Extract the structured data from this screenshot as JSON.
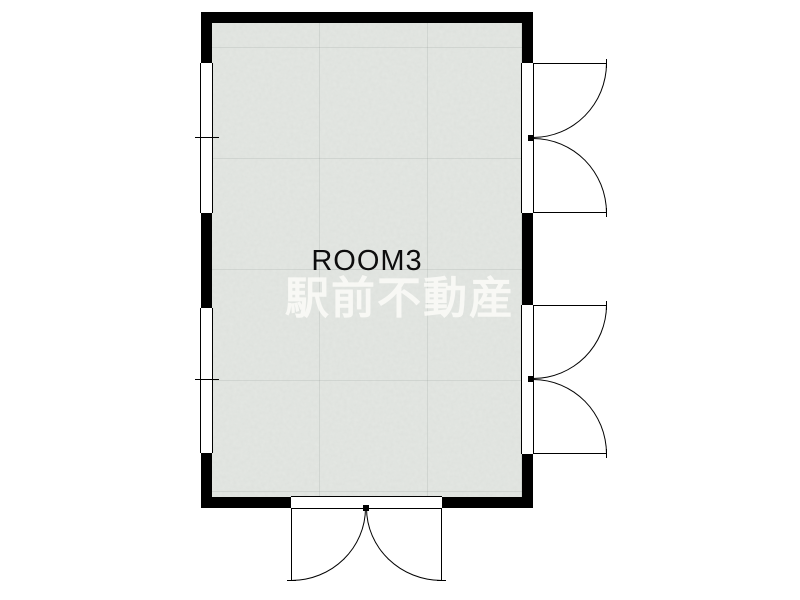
{
  "plan": {
    "room_label": "ROOM3",
    "watermark": "駅前不動産",
    "colors": {
      "background": "#ffffff",
      "wall": "#000000",
      "floor": "#e4e7e3",
      "floor_grid": "#d7dbd6",
      "line": "#000000",
      "label_text": "#0d0d0d",
      "watermark_text": "#fbfbf7"
    },
    "symbols": {
      "windows_left": [
        "sliding-window-upper-left",
        "sliding-window-lower-left"
      ],
      "doors_right": [
        "double-door-upper-right",
        "double-door-lower-right"
      ],
      "door_bottom": "double-door-bottom"
    }
  }
}
